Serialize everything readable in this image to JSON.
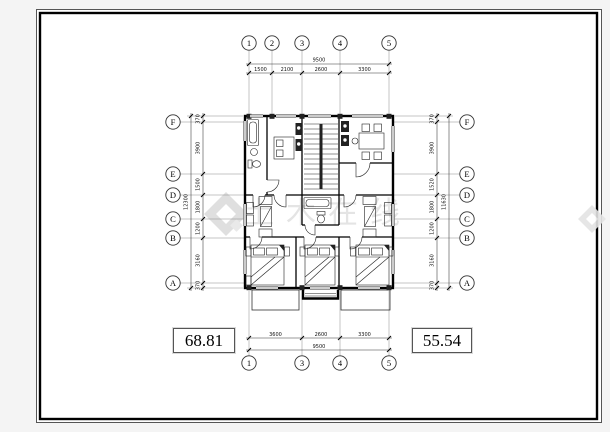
{
  "watermark": {
    "text": "土木在线"
  },
  "areas": {
    "left": "68.81",
    "right": "55.54"
  },
  "grid_bubbles": {
    "top": [
      "1",
      "2",
      "3",
      "4",
      "5"
    ],
    "bottom": [
      "1",
      "3",
      "4",
      "5"
    ],
    "left": [
      "F",
      "E",
      "D",
      "C",
      "B",
      "A"
    ],
    "right": [
      "F",
      "E",
      "D",
      "C",
      "B",
      "A"
    ]
  },
  "dims": {
    "top": {
      "total": "9500",
      "segments": [
        "1500",
        "2100",
        "2600",
        "3300"
      ]
    },
    "bottom": {
      "total": "9500",
      "segments": [
        "3600",
        "2600",
        "3300"
      ]
    },
    "left": {
      "total": "12300",
      "segments": [
        "370",
        "3900",
        "1500",
        "1800",
        "1200",
        "3160",
        "370"
      ]
    },
    "right": {
      "total": "11630",
      "segments": [
        "370",
        "3900",
        "1520",
        "1800",
        "1200",
        "3160",
        "370"
      ]
    }
  }
}
